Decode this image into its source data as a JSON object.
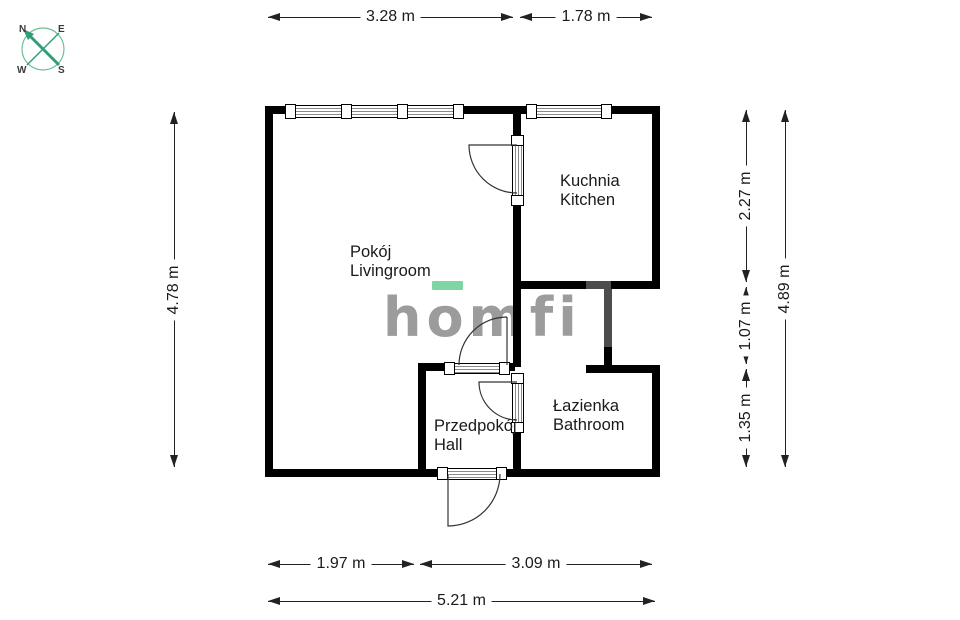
{
  "compass": {
    "n": "N",
    "e": "E",
    "w": "W",
    "s": "S"
  },
  "logo": {
    "text": "homfi"
  },
  "rooms": {
    "livingroom": {
      "pl": "Pokój",
      "en": "Livingroom"
    },
    "kitchen": {
      "pl": "Kuchnia",
      "en": "Kitchen"
    },
    "bathroom": {
      "pl": "Łazienka",
      "en": "Bathroom"
    },
    "hall": {
      "pl": "Przedpokój",
      "en": "Hall"
    }
  },
  "dimensions": {
    "top": {
      "livingroom_width": "3.28 m",
      "kitchen_width": "1.78 m"
    },
    "left": {
      "total_height": "4.78 m"
    },
    "right": {
      "kitchen_height": "2.27 m",
      "middle_height": "1.07 m",
      "bathroom_height": "1.35 m",
      "total_height": "4.89 m"
    },
    "bottom": {
      "left_width": "1.97 m",
      "right_width": "3.09 m",
      "total_width": "5.21 m"
    }
  },
  "colors": {
    "wall": "#000000",
    "secondary_wall": "#4d4d4d",
    "dimension": "#222222",
    "text": "#1a1a1a",
    "logo_gray": "#9c9c9c",
    "logo_green": "#7fd6a4",
    "compass_green": "#2f9e77",
    "compass_circle": "#6cc096"
  }
}
